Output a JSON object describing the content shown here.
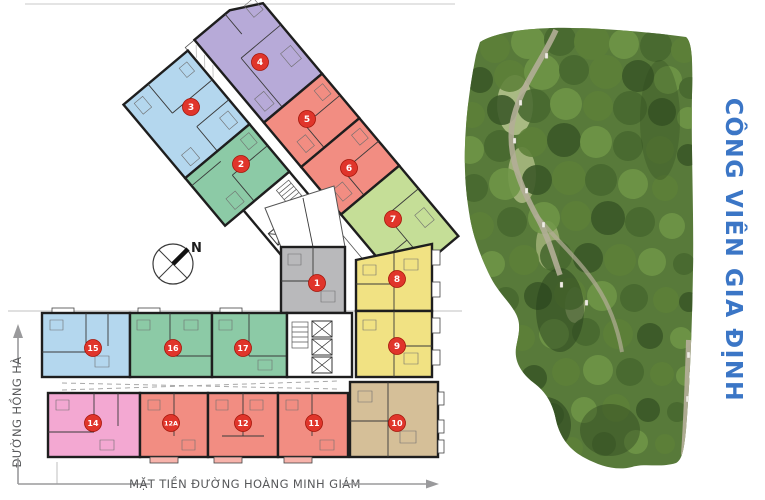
{
  "plan": {
    "compass": {
      "north_label": "N"
    },
    "streets": {
      "left_label": "ĐƯỜNG HỒNG HÀ",
      "bottom_label": "MẶT TIỀN ĐƯỜNG HOÀNG MINH GIÁM"
    },
    "badge_color": "#e0352b",
    "units": [
      {
        "number": "1",
        "color": "#b9b9bb"
      },
      {
        "number": "2",
        "color": "#8ccaa6"
      },
      {
        "number": "3",
        "color": "#b4d7ee"
      },
      {
        "number": "4",
        "color": "#b7aad8"
      },
      {
        "number": "5",
        "color": "#f28d82"
      },
      {
        "number": "6",
        "color": "#f28d82"
      },
      {
        "number": "7",
        "color": "#c5de97"
      },
      {
        "number": "8",
        "color": "#f1e283"
      },
      {
        "number": "9",
        "color": "#f1e283"
      },
      {
        "number": "10",
        "color": "#d5bf98"
      },
      {
        "number": "11",
        "color": "#f28d82"
      },
      {
        "number": "12",
        "color": "#f28d82"
      },
      {
        "number": "12A",
        "color": "#f28d82"
      },
      {
        "number": "14",
        "color": "#f3a8d2"
      },
      {
        "number": "15",
        "color": "#b4d7ee"
      },
      {
        "number": "16",
        "color": "#8ccaa6"
      },
      {
        "number": "17",
        "color": "#8ccaa6"
      }
    ]
  },
  "park": {
    "label": "CÔNG VIÊN GIA ĐỊNH",
    "label_color": "#3b76c6"
  }
}
